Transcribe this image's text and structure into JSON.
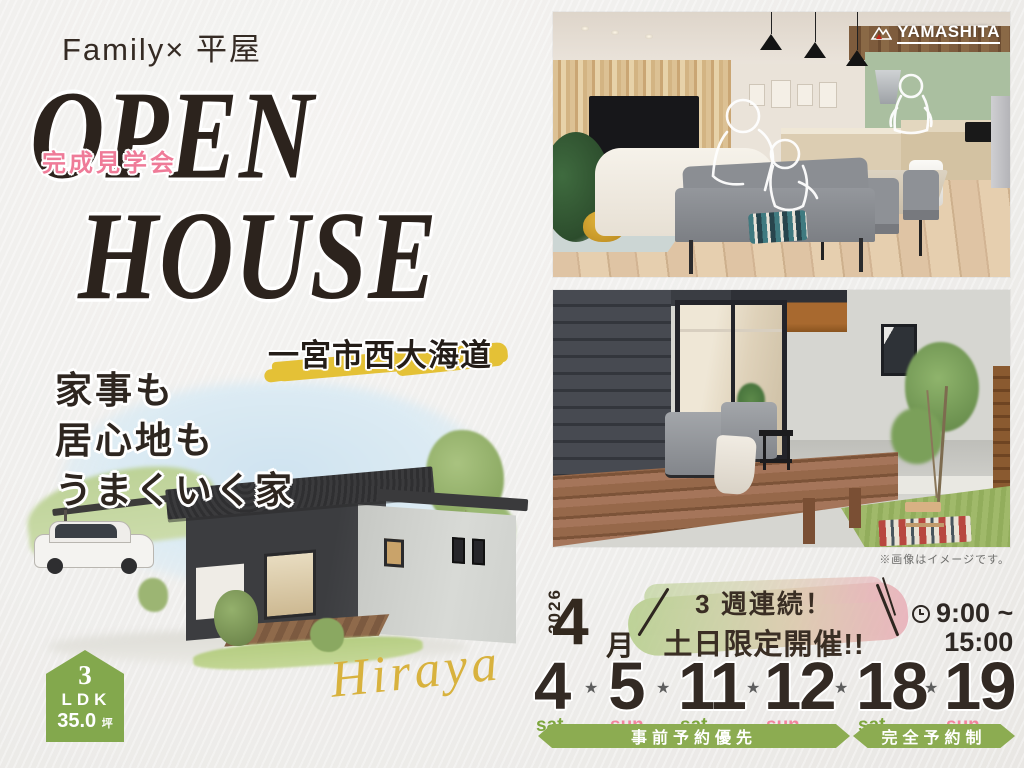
{
  "header": {
    "subtitle": "Family× 平屋"
  },
  "title": {
    "line1": "OPEN",
    "line2": "HOUSE",
    "event_badge": "完成見学会"
  },
  "location": {
    "name": "一宮市西大海道"
  },
  "catch": {
    "line1": "家事も",
    "line2": "居心地も",
    "line3": "うまくいく家"
  },
  "spec": {
    "number": "3",
    "ldk": "LDK",
    "area": "35.0",
    "unit": "坪"
  },
  "signature": {
    "text": "Hiraya"
  },
  "brand": {
    "name": "YAMASHITA"
  },
  "photos": {
    "note": "※画像はイメージです。"
  },
  "schedule": {
    "year": "2026",
    "month": "4",
    "month_suffix": "月",
    "promo_line1": "3 週連続！",
    "promo_line2": "土日限定開催!!",
    "time_line1": "9:00 ~",
    "time_line2": "15:00",
    "dates": [
      {
        "day": "4",
        "dow": "sat"
      },
      {
        "day": "5",
        "dow": "sun"
      },
      {
        "day": "11",
        "dow": "sat"
      },
      {
        "day": "12",
        "dow": "sun"
      },
      {
        "day": "18",
        "dow": "sat"
      },
      {
        "day": "19",
        "dow": "sun"
      }
    ],
    "separator": "★",
    "banner1": "事前予約優先",
    "banner2": "完全予約制"
  },
  "colors": {
    "accent_green": "#8cac51",
    "accent_pink": "#ef7b98",
    "marker_yellow": "#e4c136",
    "gold": "#d8b23e",
    "ink": "#2c231d"
  }
}
